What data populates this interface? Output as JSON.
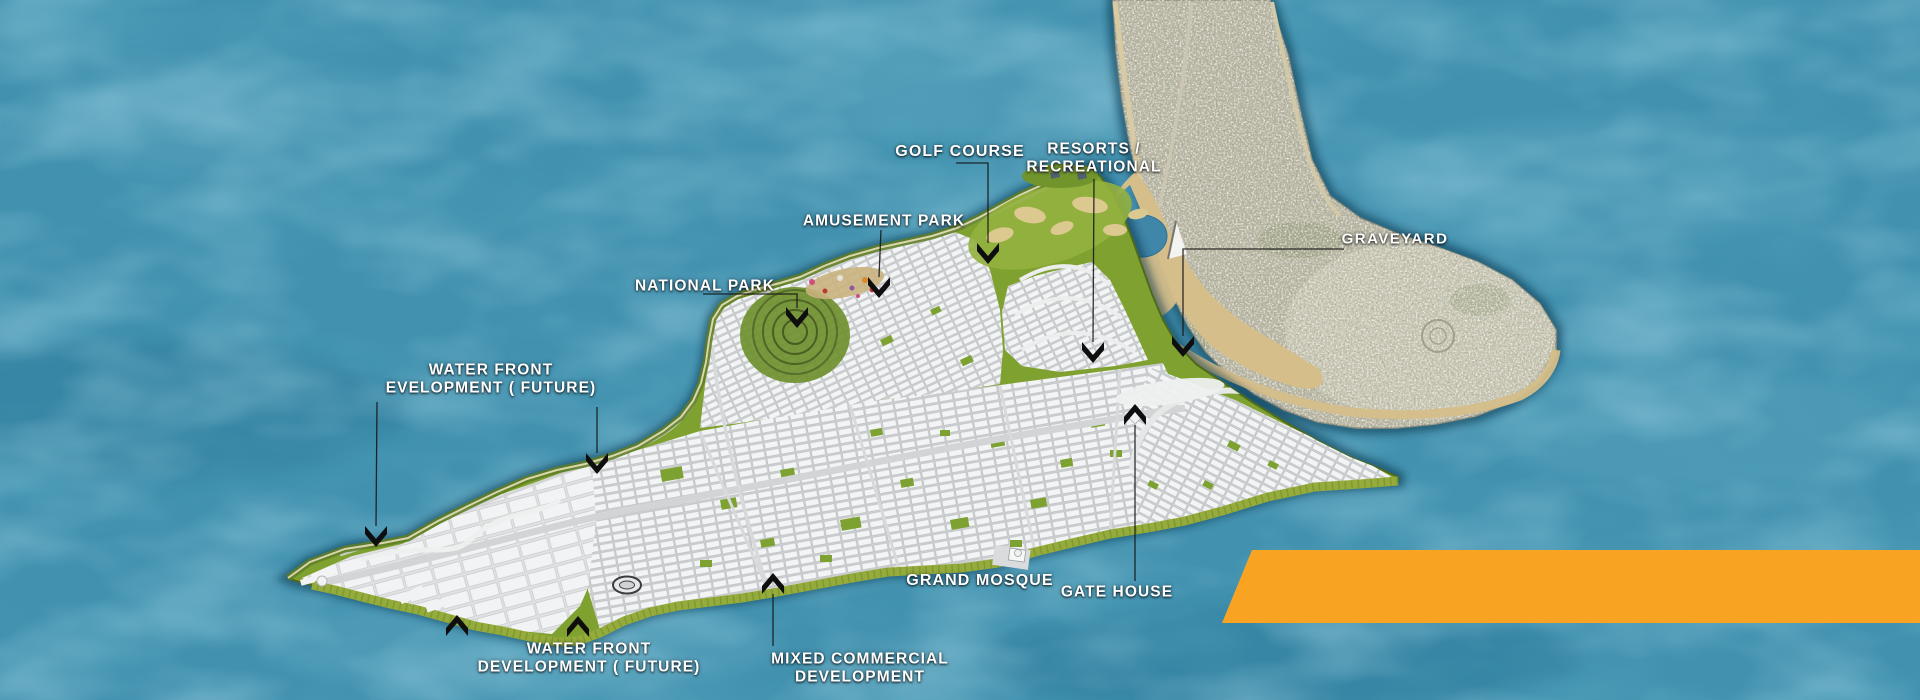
{
  "scene": {
    "description": "Aerial master plan map of a coastal peninsula development beside an existing city, surrounded by sea, with an orange banner ribbon at lower right"
  },
  "colors": {
    "water": "#4191AF",
    "water_light": "#68AFC6",
    "water_dark": "#2A7397",
    "land_green": "#7FA130",
    "land_edge": "#4F6A1D",
    "grid_light": "#F3F4F5",
    "road_gray": "#D2D4D5",
    "sand": "#D5BE8A",
    "mainland": "#B6B3A0",
    "mainland_light": "#CFCDBA",
    "banner_orange": "#F9A322",
    "label_white": "#FFFFFF",
    "leader_black": "#161616"
  },
  "map_labels": {
    "golf_course": {
      "text": "GOLF COURSE"
    },
    "resorts_recreational": {
      "line1": "RESORTS /",
      "line2": "RECREATIONAL"
    },
    "amusement_park": {
      "text": "AMUSEMENT PARK"
    },
    "national_park": {
      "text": "NATIONAL PARK"
    },
    "graveyard": {
      "text": "GRAVEYARD"
    },
    "water_front_development_future_north": {
      "line1": "WATER FRONT",
      "line2": "EVELOPMENT ( FUTURE)"
    },
    "water_front_development_future_south": {
      "line1": "WATER FRONT",
      "line2": "DEVELOPMENT ( FUTURE)"
    },
    "mixed_commercial_development": {
      "line1": "MIXED COMMERCIAL",
      "line2": "DEVELOPMENT"
    },
    "grand_mosque": {
      "text": "GRAND MOSQUE"
    },
    "gate_house": {
      "text": "GATE HOUSE"
    }
  },
  "icons": {
    "leader_arrow": "black chevron pointer",
    "graveyard_marker": "white triangle flag"
  }
}
